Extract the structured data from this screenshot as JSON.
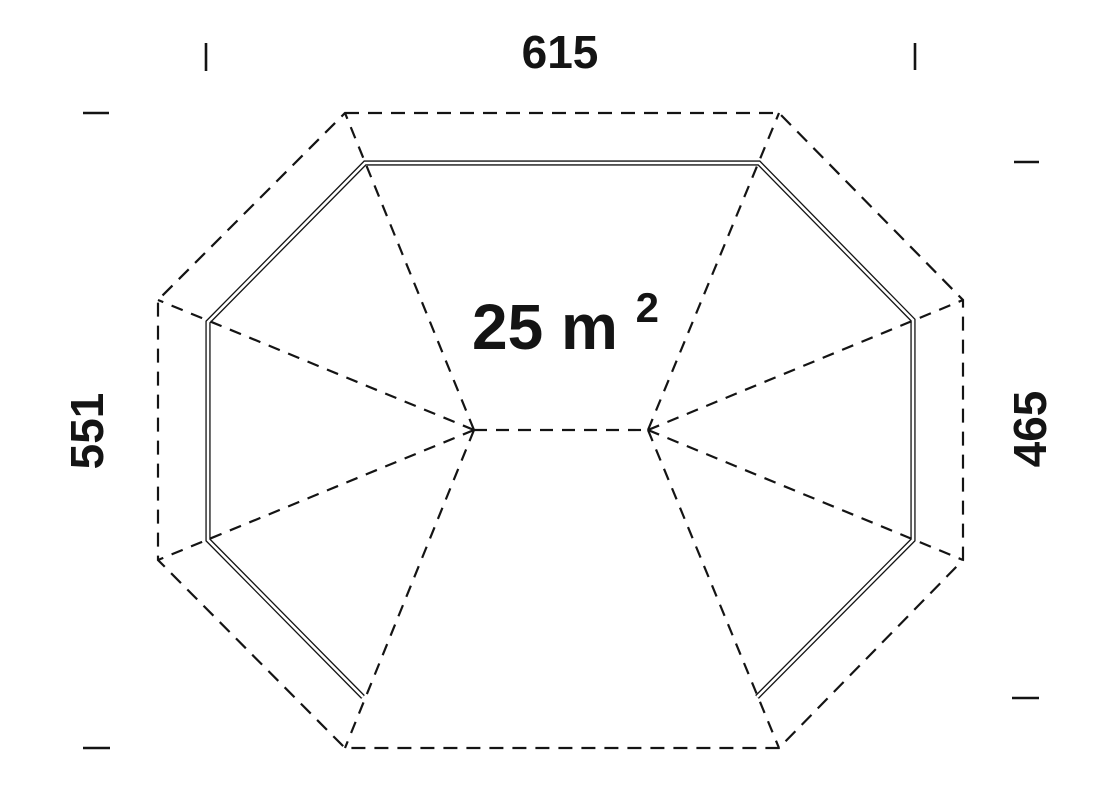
{
  "drawing": {
    "kind": "gazebo-floor-plan",
    "area": {
      "text": "25 m",
      "exponent": "2"
    },
    "dimensions": {
      "top_width": "615",
      "left_height": "551",
      "right_height": "465"
    },
    "colors": {
      "ink": "#141414",
      "background": "#ffffff"
    }
  }
}
